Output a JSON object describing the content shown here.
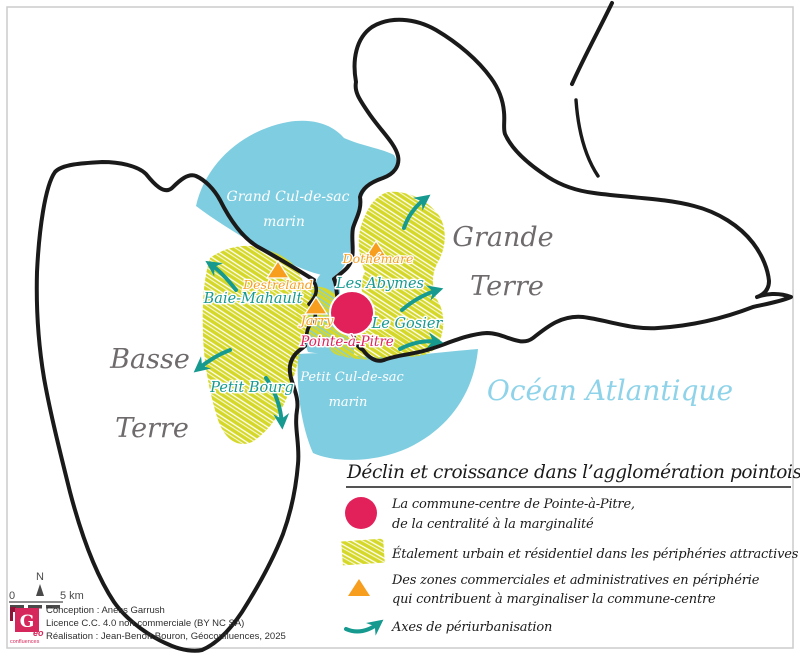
{
  "map": {
    "islands": {
      "basse_terre_line1": "Basse",
      "basse_terre_line2": "Terre",
      "grande_terre_line1": "Grande",
      "grande_terre_line2": "Terre"
    },
    "seas": {
      "grand_cul_de_sac_line1": "Grand Cul-de-sac",
      "grand_cul_de_sac_line2": "marin",
      "petit_cul_de_sac_line1": "Petit Cul-de-sac",
      "petit_cul_de_sac_line2": "marin",
      "ocean": "Océan Atlantique"
    },
    "places": {
      "baie_mahault": "Baie-Mahault",
      "petit_bourg": "Petit Bourg",
      "les_abymes": "Les Abymes",
      "le_gosier": "Le Gosier",
      "pointe_a_pitre": "Pointe-à-Pitre",
      "destreland": "Destreland",
      "jarry": "Jarry",
      "dothemare": "Dothémare"
    }
  },
  "legend": {
    "title": "Déclin et croissance dans l’agglomération pointoise",
    "items": [
      {
        "line1": "La commune-centre de Pointe-à-Pitre,",
        "line2": "de la centralité à la marginalité"
      },
      {
        "line1": "Étalement urbain et résidentiel dans les périphéries attractives"
      },
      {
        "line1": "Des zones commerciales et administratives en périphérie",
        "line2": "qui contribuent à marginaliser la commune-centre"
      },
      {
        "line1": "Axes de périurbanisation"
      }
    ]
  },
  "scale_bar": {
    "north": "N",
    "zero": "0",
    "label": "5 km"
  },
  "credits": {
    "line1": "Conception : Aness Garrush",
    "line2": "Licence C.C. 4.0 non commerciale (BY NC SA)",
    "line3": "Réalisation : Jean-Benoît Bouron, Géoconfluences, 2025"
  },
  "logo": {
    "letter": "G",
    "eo": "éo",
    "confluences": "confluences"
  },
  "colors": {
    "sea": "#7fcde0",
    "sprawl": "#d5d829",
    "teal": "#169a90",
    "orange": "#f79e1f",
    "pink": "#e2215b",
    "gray_label": "#6f6b6c",
    "ocean_label": "#8ed3e9",
    "outline": "#1a1a1a"
  }
}
